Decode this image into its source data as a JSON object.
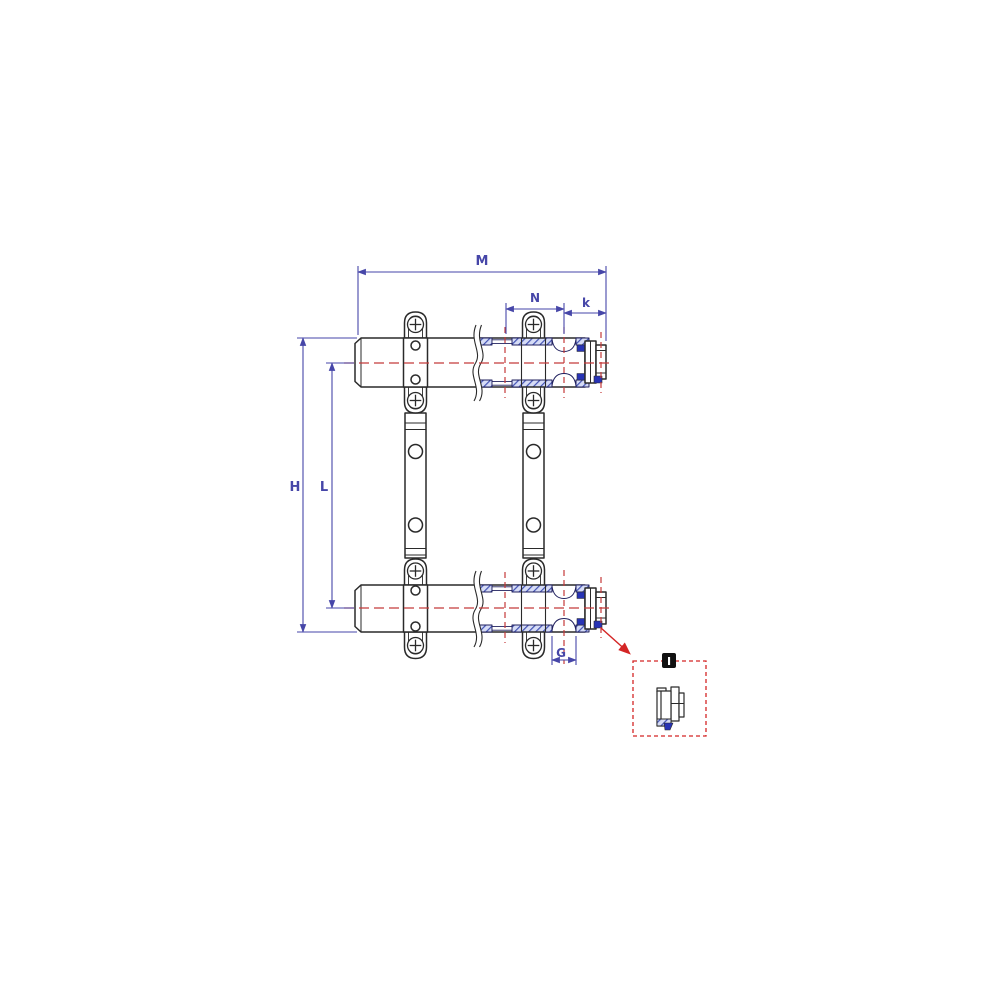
{
  "drawing": {
    "kind": "manifold-dimension-drawing",
    "views": {
      "main": "two parallel manifold bars with mounting brackets",
      "detail": "end plug fitting detail"
    }
  },
  "labels": {
    "dim_overall_width": "M",
    "dim_port_spacing": "N",
    "dim_end_offset": "k",
    "dim_overall_height": "H",
    "dim_centerline_height": "L",
    "dim_port_size": "G",
    "detail_marker": "I"
  },
  "colors": {
    "dimension": "#4646a8",
    "centerline": "#c43a3a",
    "detail_callout": "#d42525",
    "outline": "#2a2a2a",
    "hatch_stripe": "#4353b4",
    "hatch_bg": "#d6dcf6",
    "solid_fill": "#2733b5",
    "tag_bg": "#111111",
    "tag_fg": "#ffffff",
    "background": "#ffffff"
  }
}
